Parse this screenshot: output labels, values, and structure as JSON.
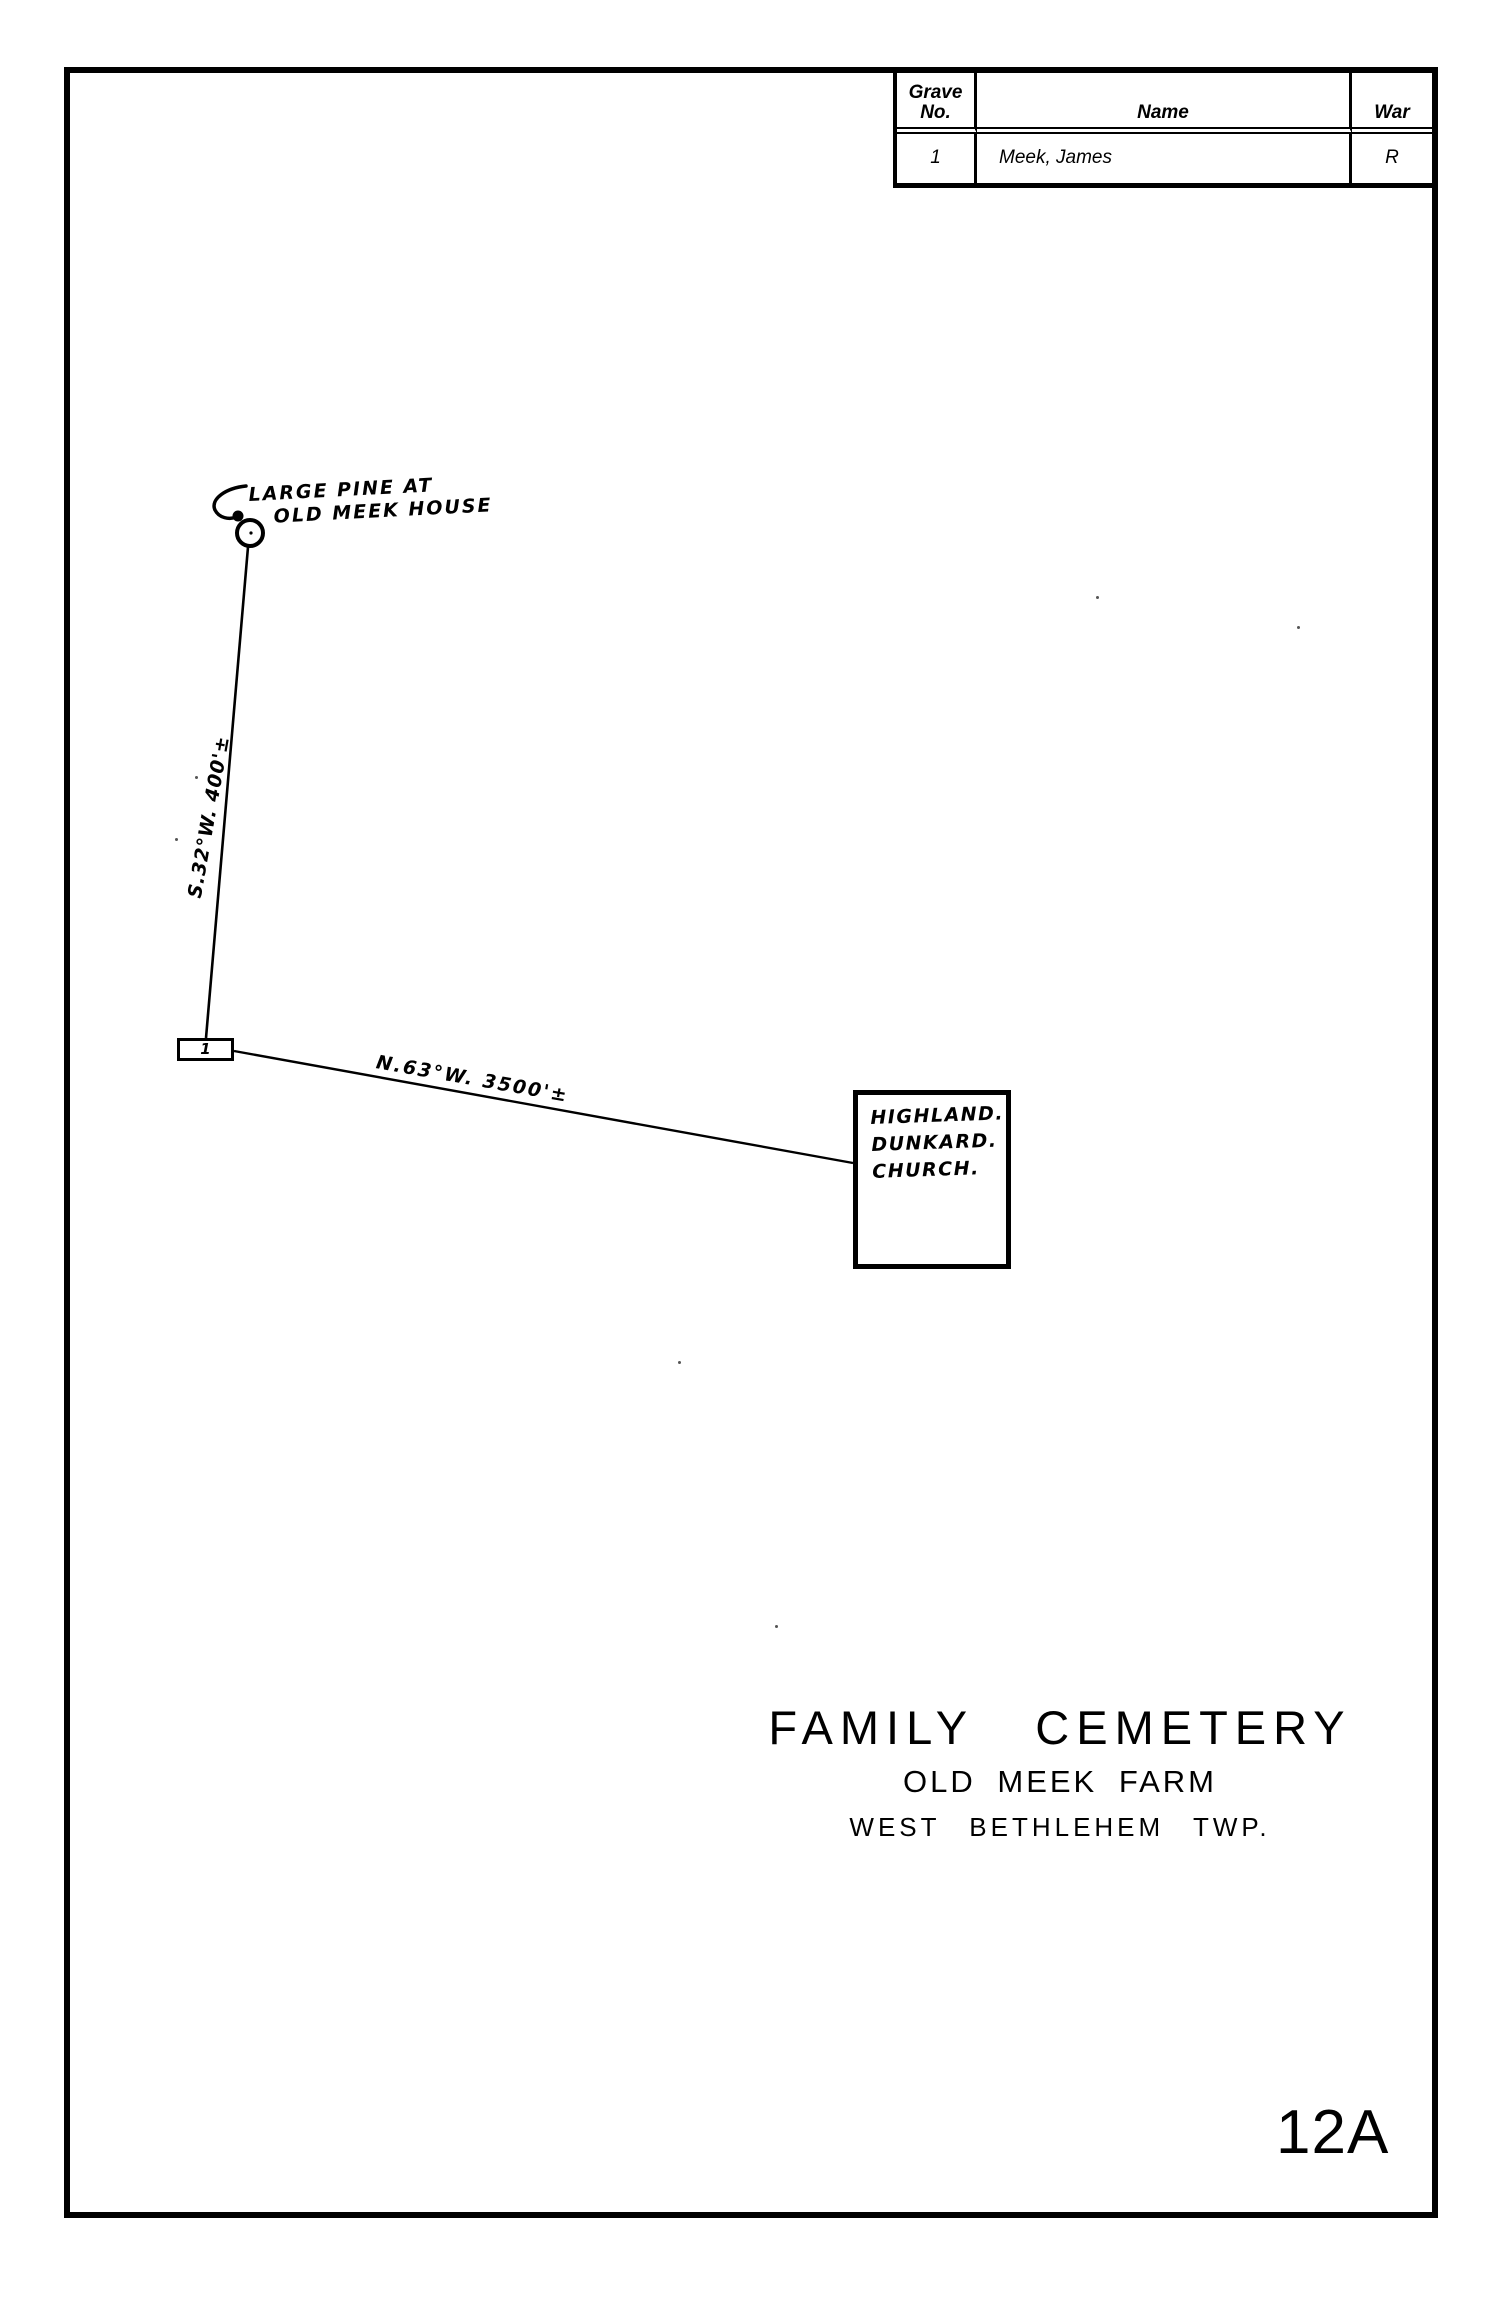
{
  "record_table": {
    "headers": {
      "grave_no": "Grave\nNo.",
      "name": "Name",
      "war": "War"
    },
    "rows": [
      {
        "grave_no": "1",
        "name": "Meek, James",
        "war": "R"
      }
    ]
  },
  "survey": {
    "landmark_label_line1": "LARGE PINE AT",
    "landmark_label_line2": "OLD MEEK HOUSE",
    "bearing_1": "S.32°W. 400'±",
    "bearing_2": "N.63°W. 3500'±",
    "grave_marker_label": "1",
    "church_label": "HIGHLAND.\nDUNKARD.\nCHURCH."
  },
  "title_block": {
    "line1": "FAMILY CEMETERY",
    "line2": "OLD MEEK FARM",
    "line3": "WEST BETHLEHEM TWP."
  },
  "page": {
    "number": "12A"
  },
  "colors": {
    "ink": "#000000",
    "paper": "#ffffff"
  }
}
